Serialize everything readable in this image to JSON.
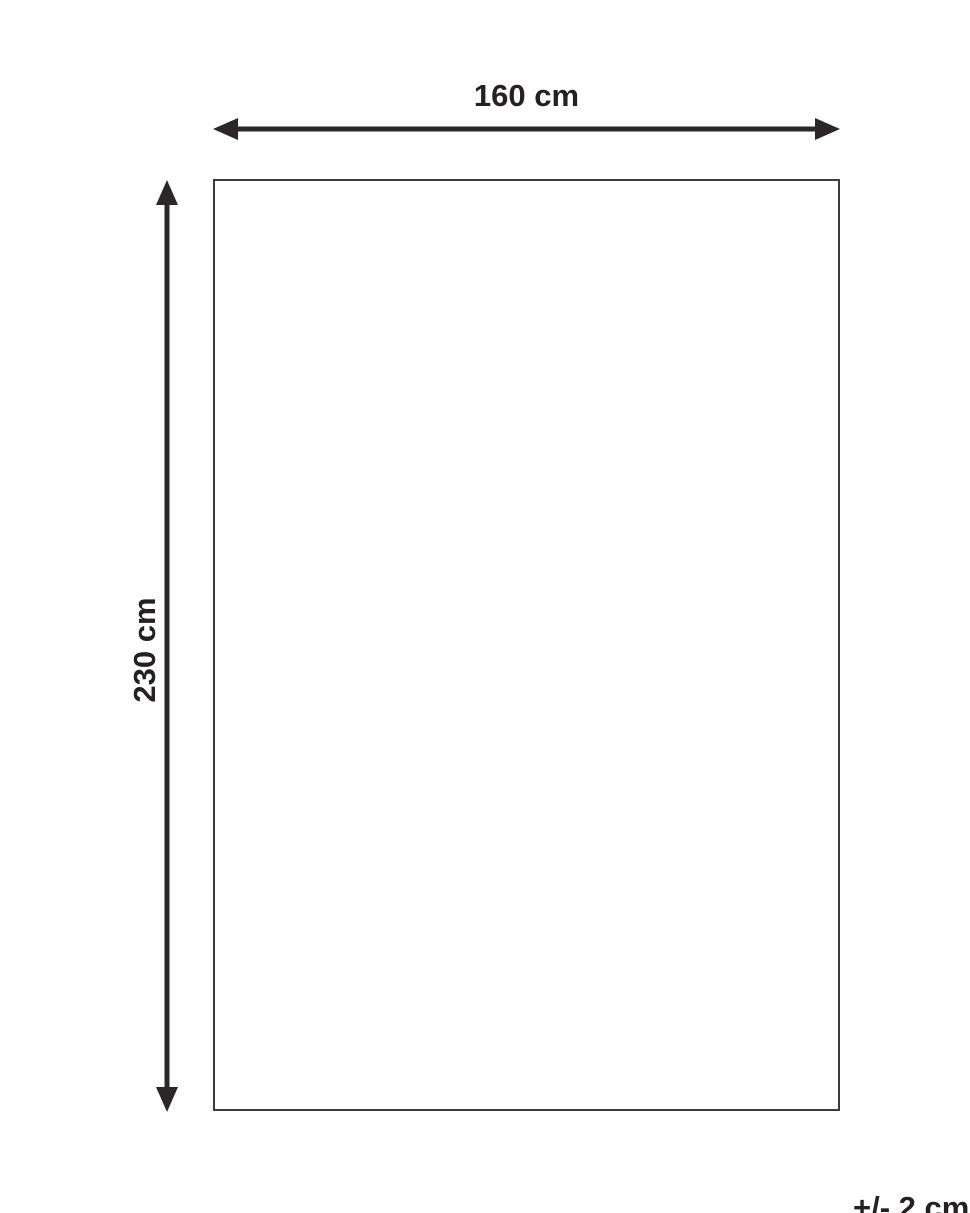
{
  "diagram": {
    "width_label": "160 cm",
    "height_label": "230 cm",
    "tolerance_label": "+/- 2 cm",
    "colors": {
      "arrow": "#2b2728",
      "text": "#242122",
      "rect_border": "#3c3c3e",
      "background": "#ffffff"
    }
  }
}
